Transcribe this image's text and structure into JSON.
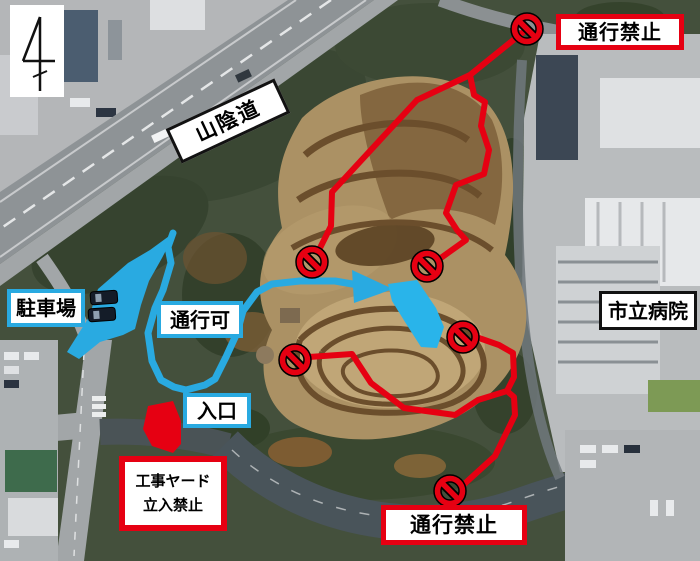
{
  "map": {
    "kind": "annotated-aerial-photo",
    "labels": {
      "expressway": "山陰道",
      "hospital": "市立病院",
      "parking": "駐車場",
      "passage_allowed": "通行可",
      "entrance": "入口",
      "no_entry_top": "通行禁止",
      "no_entry_bottom": "通行禁止",
      "construction_yard_line1": "工事ヤード",
      "construction_yard_line2": "立入禁止"
    },
    "colors": {
      "prohibited_route": "#e60012",
      "allowed_route": "#29aae1"
    },
    "symbols": {
      "no_entry_icon_count": 6,
      "north_arrow": true,
      "allowed_direction_arrow": "right"
    }
  }
}
